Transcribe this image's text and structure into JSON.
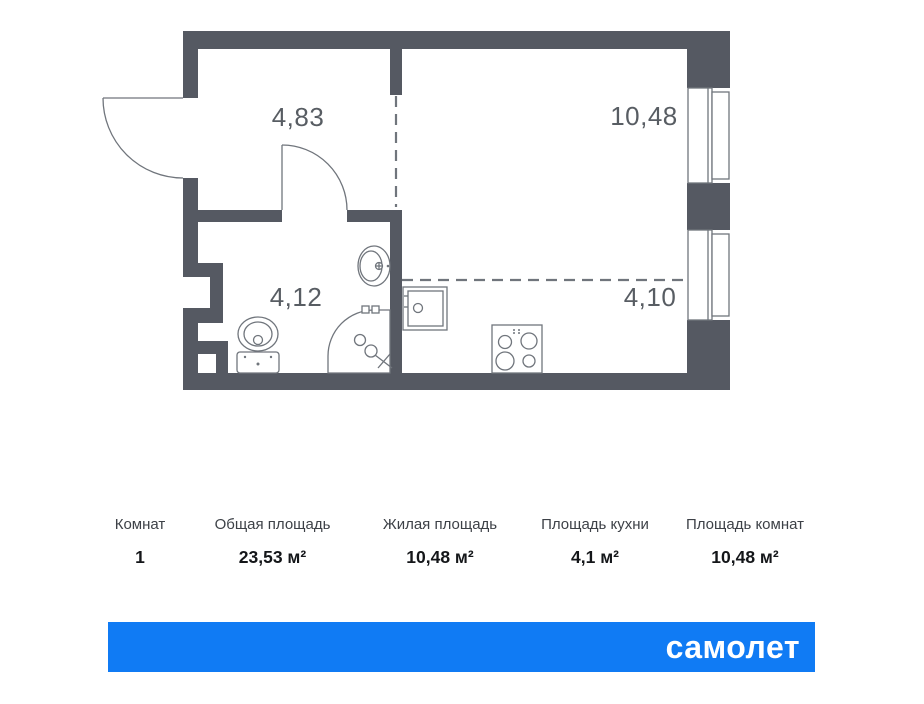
{
  "plan": {
    "rooms": [
      {
        "name": "hallway",
        "area_label": "4,83"
      },
      {
        "name": "living-room",
        "area_label": "10,48"
      },
      {
        "name": "bathroom",
        "area_label": "4,12"
      },
      {
        "name": "kitchen",
        "area_label": "4,10"
      }
    ],
    "fixtures": [
      "entrance-door",
      "bathroom-door",
      "toilet",
      "bathroom-sink",
      "shower-cabin",
      "kitchen-sink",
      "stove",
      "window",
      "window"
    ]
  },
  "summary": {
    "columns": [
      {
        "label": "Комнат",
        "value": "1"
      },
      {
        "label": "Общая площадь",
        "value": "23,53 м²"
      },
      {
        "label": "Жилая площадь",
        "value": "10,48 м²"
      },
      {
        "label": "Площадь кухни",
        "value": "4,1 м²"
      },
      {
        "label": "Площадь комнат",
        "value": "10,48 м²"
      }
    ]
  },
  "brand": {
    "logo_text": "самолет"
  },
  "colors": {
    "wall": "#555962",
    "thin_line": "#70757C",
    "room_label": "#585D63",
    "brand_blue": "#107BF4",
    "value_text": "#141619",
    "header_text": "#3D4147"
  }
}
